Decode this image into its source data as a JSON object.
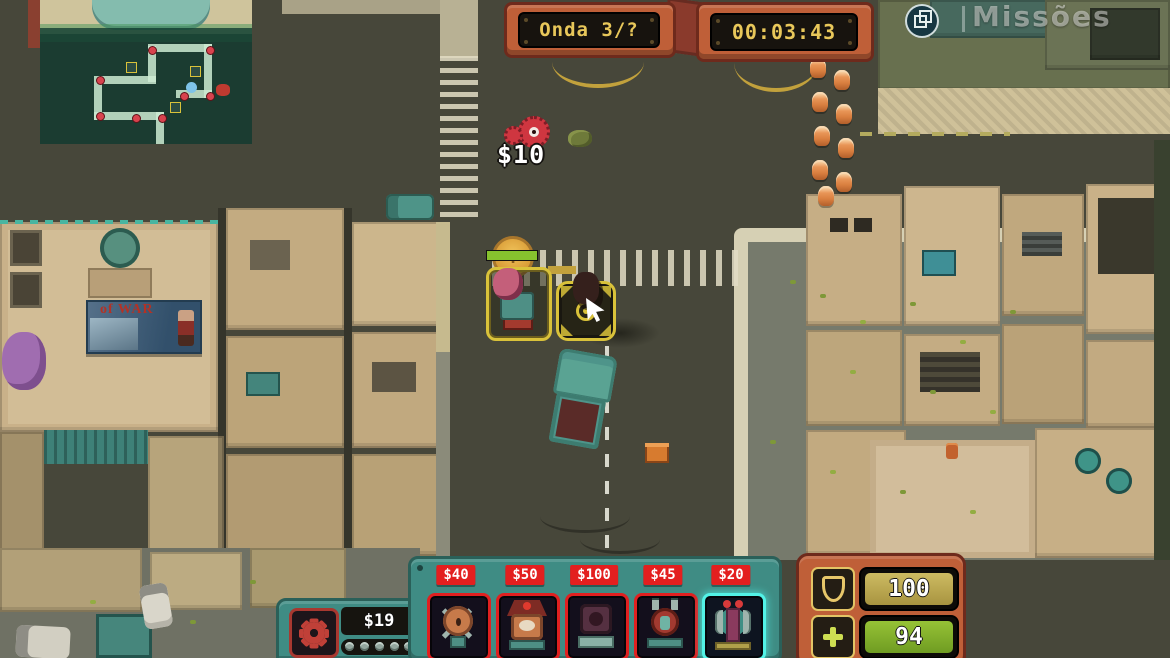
{
  "hud": {
    "wave": {
      "label": "Onda 3/?"
    },
    "timer": {
      "value": "00:03:43"
    },
    "missions_label": "Missões",
    "floating_reward": "$10",
    "rally_coin_letter": "Y",
    "money": "$19",
    "shield_value": "100",
    "health_value": "94",
    "shop_cards": [
      {
        "id": "tower-1",
        "price": "$40",
        "selected": false
      },
      {
        "id": "tower-2",
        "price": "$50",
        "selected": false
      },
      {
        "id": "tower-3",
        "price": "$100",
        "selected": false
      },
      {
        "id": "tower-4",
        "price": "$45",
        "selected": false
      },
      {
        "id": "tower-5",
        "price": "$20",
        "selected": true
      }
    ]
  },
  "map": {
    "billboard_text": "of WAR"
  },
  "colors": {
    "panel_orange": "#bf5f38",
    "panel_teal": "#3f8c84",
    "price_red": "#e31f1f",
    "selected_cyan": "#52f2e6",
    "hud_text_yellow": "#e8c75a",
    "shield_bar_gold": "#b3a14a",
    "health_bar_green": "#7fae2a",
    "road": "#47473a"
  }
}
